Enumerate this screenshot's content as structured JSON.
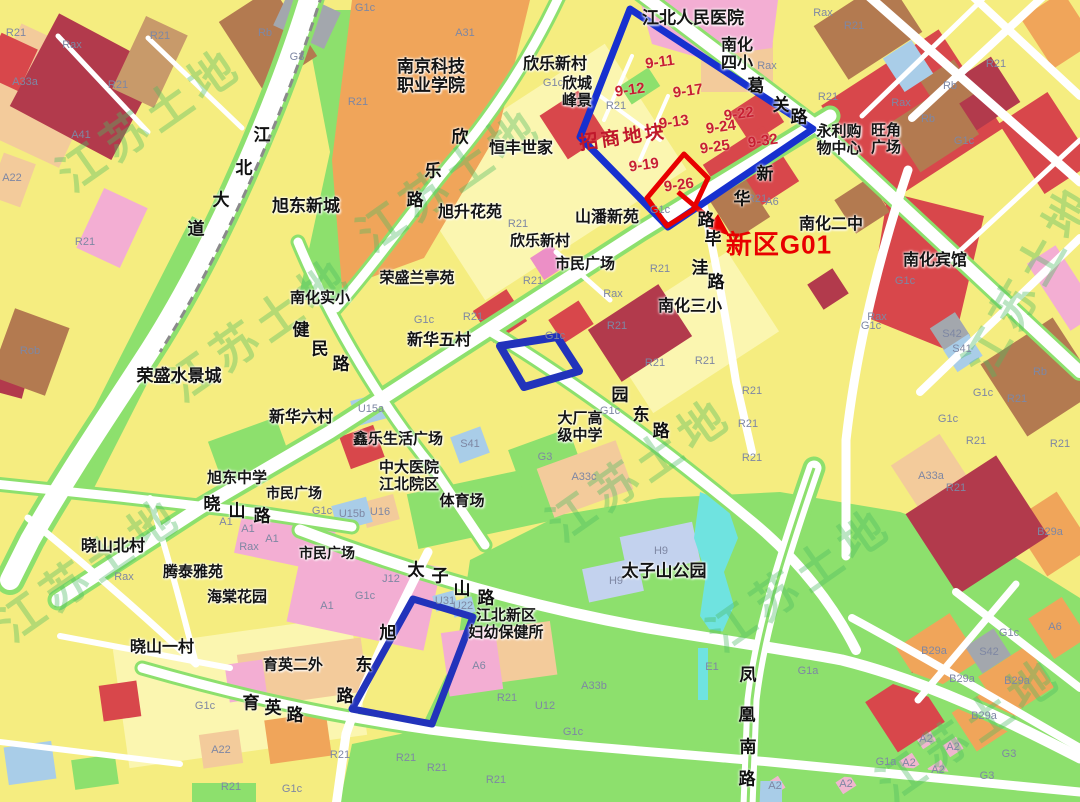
{
  "map": {
    "title_hint": "urban zoning map with land-parcel annotations",
    "watermark": {
      "text": "江苏土地",
      "positions": [
        {
          "x": 150,
          "y": 120,
          "rot": -35
        },
        {
          "x": 450,
          "y": 180,
          "rot": -35
        },
        {
          "x": 260,
          "y": 330,
          "rot": -35
        },
        {
          "x": 640,
          "y": 470,
          "rot": -35
        },
        {
          "x": 800,
          "y": 580,
          "rot": -35
        },
        {
          "x": 1030,
          "y": 280,
          "rot": -60
        },
        {
          "x": 970,
          "y": 730,
          "rot": -35
        },
        {
          "x": 90,
          "y": 570,
          "rot": -35
        }
      ]
    },
    "colors": {
      "residential_yellow": "#f5ed80",
      "pale_yellow": "#fbf6b0",
      "green_space": "#8de06d",
      "commercial_red": "#d8474b",
      "dark_red": "#b23a4c",
      "public_orange": "#f0a55a",
      "school_peach": "#f3cb9b",
      "pink": "#f3aed3",
      "brown": "#b37a50",
      "gray": "#a3a7ad",
      "light_blue": "#a9cde8",
      "lavender": "#c3d2ee",
      "water_cyan": "#6fe3e0",
      "road_white": "#ffffff",
      "annotation_blue": "#1730cf",
      "annotation_red": "#e80000",
      "parcel_number_red": "#c81f33",
      "watermark_green": "#4cba60",
      "badge_olive": "#6c6a3a"
    },
    "annotations": {
      "promo_label": {
        "text": "招商地块",
        "x": 623,
        "y": 138
      },
      "target_label": {
        "text": "新区G01",
        "x": 779,
        "y": 245
      },
      "parcel_numbers": [
        {
          "text": "9-11",
          "x": 660,
          "y": 63
        },
        {
          "text": "9-12",
          "x": 630,
          "y": 91
        },
        {
          "text": "9-17",
          "x": 688,
          "y": 92
        },
        {
          "text": "9-13",
          "x": 674,
          "y": 123
        },
        {
          "text": "9-22",
          "x": 739,
          "y": 115
        },
        {
          "text": "9-24",
          "x": 721,
          "y": 128
        },
        {
          "text": "9-25",
          "x": 715,
          "y": 148
        },
        {
          "text": "9-32",
          "x": 763,
          "y": 142
        },
        {
          "text": "9-19",
          "x": 644,
          "y": 166
        },
        {
          "text": "9-26",
          "x": 679,
          "y": 186
        }
      ],
      "badges": [
        {
          "text": "22",
          "x": 671,
          "y": 129
        },
        {
          "text": "24",
          "x": 535,
          "y": 352
        },
        {
          "text": "23",
          "x": 416,
          "y": 657
        }
      ]
    },
    "road_labels": [
      {
        "name": "geguan-road",
        "chars": [
          {
            "ch": "葛",
            "x": 756,
            "y": 87
          },
          {
            "ch": "关",
            "x": 781,
            "y": 106
          },
          {
            "ch": "路",
            "x": 799,
            "y": 118
          }
        ]
      },
      {
        "name": "xinhua-road",
        "chars": [
          {
            "ch": "新",
            "x": 765,
            "y": 175
          },
          {
            "ch": "华",
            "x": 742,
            "y": 200
          },
          {
            "ch": "路",
            "x": 706,
            "y": 221
          }
        ]
      },
      {
        "name": "biwa-road",
        "chars": [
          {
            "ch": "毕",
            "x": 713,
            "y": 240
          },
          {
            "ch": "洼",
            "x": 700,
            "y": 269
          },
          {
            "ch": "路",
            "x": 716,
            "y": 283
          }
        ]
      },
      {
        "name": "xinle-road",
        "chars": [
          {
            "ch": "欣",
            "x": 460,
            "y": 138
          },
          {
            "ch": "乐",
            "x": 433,
            "y": 172
          },
          {
            "ch": "路",
            "x": 415,
            "y": 201
          }
        ]
      },
      {
        "name": "jiangbei-avenue",
        "chars": [
          {
            "ch": "江",
            "x": 262,
            "y": 136
          },
          {
            "ch": "北",
            "x": 244,
            "y": 169
          },
          {
            "ch": "大",
            "x": 221,
            "y": 201
          },
          {
            "ch": "道",
            "x": 196,
            "y": 230
          }
        ]
      },
      {
        "name": "jianmin-road",
        "chars": [
          {
            "ch": "健",
            "x": 301,
            "y": 331
          },
          {
            "ch": "民",
            "x": 320,
            "y": 350
          },
          {
            "ch": "路",
            "x": 341,
            "y": 365
          }
        ]
      },
      {
        "name": "yuandong-road",
        "chars": [
          {
            "ch": "园",
            "x": 620,
            "y": 396
          },
          {
            "ch": "东",
            "x": 641,
            "y": 416
          },
          {
            "ch": "路",
            "x": 661,
            "y": 432
          }
        ]
      },
      {
        "name": "xiaoshan-road",
        "chars": [
          {
            "ch": "晓",
            "x": 212,
            "y": 505
          },
          {
            "ch": "山",
            "x": 237,
            "y": 512
          },
          {
            "ch": "路",
            "x": 262,
            "y": 517
          }
        ]
      },
      {
        "name": "taizishan-road",
        "chars": [
          {
            "ch": "太",
            "x": 416,
            "y": 571
          },
          {
            "ch": "子",
            "x": 440,
            "y": 577
          },
          {
            "ch": "山",
            "x": 462,
            "y": 590
          },
          {
            "ch": "路",
            "x": 486,
            "y": 599
          }
        ]
      },
      {
        "name": "yuying-road",
        "chars": [
          {
            "ch": "育",
            "x": 251,
            "y": 704
          },
          {
            "ch": "英",
            "x": 273,
            "y": 709
          },
          {
            "ch": "路",
            "x": 295,
            "y": 716
          }
        ]
      },
      {
        "name": "xudong-road",
        "chars": [
          {
            "ch": "旭",
            "x": 388,
            "y": 634
          },
          {
            "ch": "东",
            "x": 364,
            "y": 666
          },
          {
            "ch": "路",
            "x": 345,
            "y": 697
          }
        ]
      },
      {
        "name": "fenghuang-south-road",
        "chars": [
          {
            "ch": "凤",
            "x": 748,
            "y": 676
          },
          {
            "ch": "凰",
            "x": 747,
            "y": 716
          },
          {
            "ch": "南",
            "x": 748,
            "y": 748
          },
          {
            "ch": "路",
            "x": 747,
            "y": 780
          }
        ]
      }
    ],
    "place_labels": [
      {
        "text": "江北人民医院",
        "x": 693,
        "y": 19,
        "s": 17
      },
      {
        "text": "南化\n四小",
        "x": 737,
        "y": 54,
        "s": 16
      },
      {
        "text": "南京科技\n职业学院",
        "x": 431,
        "y": 77,
        "s": 17
      },
      {
        "text": "欣乐新村",
        "x": 555,
        "y": 64,
        "s": 16
      },
      {
        "text": "欣城\n峰景",
        "x": 577,
        "y": 92,
        "s": 15
      },
      {
        "text": "恒丰世家",
        "x": 521,
        "y": 148,
        "s": 16
      },
      {
        "text": "旭东新城",
        "x": 306,
        "y": 207,
        "s": 17
      },
      {
        "text": "旭升花苑",
        "x": 470,
        "y": 212,
        "s": 16
      },
      {
        "text": "山潘新苑",
        "x": 607,
        "y": 217,
        "s": 16
      },
      {
        "text": "欣乐新村",
        "x": 540,
        "y": 241,
        "s": 15
      },
      {
        "text": "市民广场",
        "x": 585,
        "y": 264,
        "s": 15
      },
      {
        "text": "南化二中",
        "x": 831,
        "y": 224,
        "s": 16
      },
      {
        "text": "南化宾馆",
        "x": 935,
        "y": 260,
        "s": 16
      },
      {
        "text": "荣盛兰亭苑",
        "x": 417,
        "y": 278,
        "s": 15
      },
      {
        "text": "南化实小",
        "x": 320,
        "y": 298,
        "s": 15
      },
      {
        "text": "新华五村",
        "x": 439,
        "y": 340,
        "s": 16
      },
      {
        "text": "南化三小",
        "x": 690,
        "y": 306,
        "s": 16
      },
      {
        "text": "荣盛水景城",
        "x": 179,
        "y": 377,
        "s": 17
      },
      {
        "text": "新华六村",
        "x": 301,
        "y": 417,
        "s": 16
      },
      {
        "text": "鑫乐生活广场",
        "x": 398,
        "y": 439,
        "s": 15
      },
      {
        "text": "中大医院\n江北院区",
        "x": 409,
        "y": 476,
        "s": 15
      },
      {
        "text": "大厂高\n级中学",
        "x": 580,
        "y": 427,
        "s": 15
      },
      {
        "text": "体育场",
        "x": 462,
        "y": 501,
        "s": 15
      },
      {
        "text": "旭东中学",
        "x": 237,
        "y": 478,
        "s": 15
      },
      {
        "text": "市民广场",
        "x": 294,
        "y": 495,
        "s": 14
      },
      {
        "text": "市民广场",
        "x": 327,
        "y": 555,
        "s": 14
      },
      {
        "text": "晓山北村",
        "x": 113,
        "y": 546,
        "s": 16
      },
      {
        "text": "腾泰雅苑",
        "x": 193,
        "y": 572,
        "s": 15
      },
      {
        "text": "海棠花园",
        "x": 237,
        "y": 597,
        "s": 15
      },
      {
        "text": "晓山一村",
        "x": 162,
        "y": 647,
        "s": 16
      },
      {
        "text": "太子山公园",
        "x": 664,
        "y": 572,
        "s": 17
      },
      {
        "text": "江北新区\n妇幼保健所",
        "x": 506,
        "y": 624,
        "s": 15
      },
      {
        "text": "育英二外",
        "x": 293,
        "y": 665,
        "s": 15
      },
      {
        "text": "永利购\n物中心",
        "x": 839,
        "y": 140,
        "s": 15
      },
      {
        "text": "旺角\n广场",
        "x": 886,
        "y": 139,
        "s": 15
      }
    ],
    "zone_codes": [
      {
        "text": "R21",
        "x": 16,
        "y": 33
      },
      {
        "text": "R21",
        "x": 160,
        "y": 36
      },
      {
        "text": "R21",
        "x": 118,
        "y": 85
      },
      {
        "text": "R21",
        "x": 854,
        "y": 26
      },
      {
        "text": "R21",
        "x": 996,
        "y": 64
      },
      {
        "text": "R21",
        "x": 828,
        "y": 97
      },
      {
        "text": "R21",
        "x": 616,
        "y": 106
      },
      {
        "text": "R21",
        "x": 358,
        "y": 102
      },
      {
        "text": "R21",
        "x": 757,
        "y": 199
      },
      {
        "text": "R21",
        "x": 518,
        "y": 224
      },
      {
        "text": "R21",
        "x": 660,
        "y": 269
      },
      {
        "text": "R21",
        "x": 533,
        "y": 281
      },
      {
        "text": "R21",
        "x": 473,
        "y": 317
      },
      {
        "text": "R21",
        "x": 617,
        "y": 326
      },
      {
        "text": "R21",
        "x": 655,
        "y": 363
      },
      {
        "text": "R21",
        "x": 705,
        "y": 361
      },
      {
        "text": "R21",
        "x": 752,
        "y": 391
      },
      {
        "text": "R21",
        "x": 748,
        "y": 424
      },
      {
        "text": "R21",
        "x": 752,
        "y": 458
      },
      {
        "text": "R21",
        "x": 1017,
        "y": 399
      },
      {
        "text": "R21",
        "x": 976,
        "y": 441
      },
      {
        "text": "R21",
        "x": 1060,
        "y": 444
      },
      {
        "text": "R21",
        "x": 956,
        "y": 488
      },
      {
        "text": "R21",
        "x": 507,
        "y": 698
      },
      {
        "text": "R21",
        "x": 340,
        "y": 755
      },
      {
        "text": "R21",
        "x": 406,
        "y": 758
      },
      {
        "text": "R21",
        "x": 437,
        "y": 768
      },
      {
        "text": "R21",
        "x": 496,
        "y": 780
      },
      {
        "text": "R21",
        "x": 231,
        "y": 787
      },
      {
        "text": "R21",
        "x": 85,
        "y": 242
      },
      {
        "text": "Rax",
        "x": 72,
        "y": 45
      },
      {
        "text": "Rax",
        "x": 823,
        "y": 13
      },
      {
        "text": "Rax",
        "x": 767,
        "y": 66
      },
      {
        "text": "Rax",
        "x": 901,
        "y": 103
      },
      {
        "text": "Rax",
        "x": 877,
        "y": 317
      },
      {
        "text": "Rax",
        "x": 613,
        "y": 294
      },
      {
        "text": "Rax",
        "x": 249,
        "y": 547
      },
      {
        "text": "Rax",
        "x": 124,
        "y": 577
      },
      {
        "text": "G1c",
        "x": 365,
        "y": 8
      },
      {
        "text": "G1c",
        "x": 553,
        "y": 83
      },
      {
        "text": "G1c",
        "x": 660,
        "y": 210
      },
      {
        "text": "G1c",
        "x": 424,
        "y": 320
      },
      {
        "text": "G1c",
        "x": 555,
        "y": 336
      },
      {
        "text": "G1c",
        "x": 610,
        "y": 411
      },
      {
        "text": "G1c",
        "x": 964,
        "y": 141
      },
      {
        "text": "G1c",
        "x": 905,
        "y": 281
      },
      {
        "text": "G1c",
        "x": 871,
        "y": 326
      },
      {
        "text": "G1c",
        "x": 322,
        "y": 511
      },
      {
        "text": "G1c",
        "x": 365,
        "y": 596
      },
      {
        "text": "G1c",
        "x": 573,
        "y": 732
      },
      {
        "text": "G1c",
        "x": 1009,
        "y": 633
      },
      {
        "text": "G1c",
        "x": 205,
        "y": 706
      },
      {
        "text": "G1c",
        "x": 292,
        "y": 789
      },
      {
        "text": "G1c",
        "x": 948,
        "y": 419
      },
      {
        "text": "G1c",
        "x": 983,
        "y": 393
      },
      {
        "text": "G1a",
        "x": 808,
        "y": 671
      },
      {
        "text": "G1a",
        "x": 886,
        "y": 762
      },
      {
        "text": "Rob",
        "x": 30,
        "y": 351
      },
      {
        "text": "Rb",
        "x": 265,
        "y": 33
      },
      {
        "text": "Rb",
        "x": 950,
        "y": 86
      },
      {
        "text": "Rb",
        "x": 928,
        "y": 119
      },
      {
        "text": "Rb",
        "x": 1040,
        "y": 372
      },
      {
        "text": "A31",
        "x": 465,
        "y": 33
      },
      {
        "text": "A41",
        "x": 81,
        "y": 135
      },
      {
        "text": "A33a",
        "x": 25,
        "y": 82
      },
      {
        "text": "A33a",
        "x": 931,
        "y": 476
      },
      {
        "text": "A33b",
        "x": 594,
        "y": 686
      },
      {
        "text": "A33c",
        "x": 584,
        "y": 477
      },
      {
        "text": "A22",
        "x": 12,
        "y": 178
      },
      {
        "text": "A22",
        "x": 221,
        "y": 750
      },
      {
        "text": "A1",
        "x": 226,
        "y": 522
      },
      {
        "text": "A1",
        "x": 248,
        "y": 529
      },
      {
        "text": "A1",
        "x": 272,
        "y": 539
      },
      {
        "text": "A1",
        "x": 327,
        "y": 606
      },
      {
        "text": "A2",
        "x": 926,
        "y": 739
      },
      {
        "text": "A2",
        "x": 909,
        "y": 763
      },
      {
        "text": "A2",
        "x": 953,
        "y": 747
      },
      {
        "text": "A2",
        "x": 938,
        "y": 770
      },
      {
        "text": "A2",
        "x": 846,
        "y": 784
      },
      {
        "text": "A2",
        "x": 775,
        "y": 786
      },
      {
        "text": "A6",
        "x": 479,
        "y": 666
      },
      {
        "text": "A6",
        "x": 772,
        "y": 202
      },
      {
        "text": "A6",
        "x": 1055,
        "y": 627
      },
      {
        "text": "U15a",
        "x": 371,
        "y": 409
      },
      {
        "text": "U15b",
        "x": 352,
        "y": 514
      },
      {
        "text": "U16",
        "x": 380,
        "y": 512
      },
      {
        "text": "U31",
        "x": 445,
        "y": 601
      },
      {
        "text": "U22",
        "x": 463,
        "y": 606
      },
      {
        "text": "U12",
        "x": 545,
        "y": 706
      },
      {
        "text": "J12",
        "x": 391,
        "y": 579
      },
      {
        "text": "S41",
        "x": 470,
        "y": 444
      },
      {
        "text": "S41",
        "x": 962,
        "y": 349
      },
      {
        "text": "S42",
        "x": 952,
        "y": 334
      },
      {
        "text": "S42",
        "x": 989,
        "y": 652
      },
      {
        "text": "H9",
        "x": 661,
        "y": 551
      },
      {
        "text": "H9",
        "x": 616,
        "y": 581
      },
      {
        "text": "G3",
        "x": 297,
        "y": 57
      },
      {
        "text": "G3",
        "x": 545,
        "y": 457
      },
      {
        "text": "G3",
        "x": 1009,
        "y": 754
      },
      {
        "text": "G3",
        "x": 987,
        "y": 776
      },
      {
        "text": "E1",
        "x": 712,
        "y": 667
      },
      {
        "text": "B29a",
        "x": 934,
        "y": 651
      },
      {
        "text": "B29a",
        "x": 962,
        "y": 679
      },
      {
        "text": "B29a",
        "x": 1017,
        "y": 681
      },
      {
        "text": "B29a",
        "x": 984,
        "y": 716
      },
      {
        "text": "B29a",
        "x": 1050,
        "y": 532
      }
    ]
  }
}
